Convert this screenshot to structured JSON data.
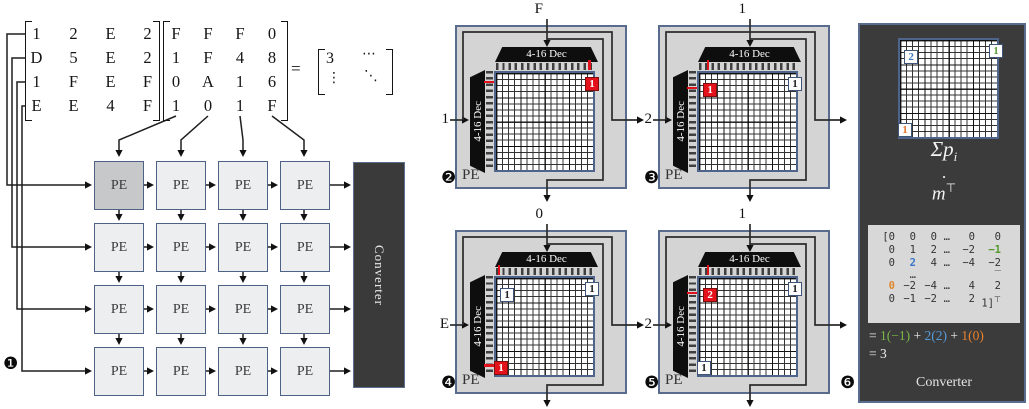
{
  "equation": {
    "matrix_a": {
      "rows": [
        [
          "1",
          "2",
          "E",
          "2"
        ],
        [
          "D",
          "5",
          "E",
          "2"
        ],
        [
          "1",
          "F",
          "E",
          "F"
        ],
        [
          "E",
          "E",
          "4",
          "F"
        ]
      ]
    },
    "matrix_b": {
      "rows": [
        [
          "F",
          "F",
          "F",
          "0"
        ],
        [
          "1",
          "F",
          "4",
          "8"
        ],
        [
          "0",
          "A",
          "1",
          "6"
        ],
        [
          "1",
          "0",
          "1",
          "F"
        ]
      ]
    },
    "equals": "=",
    "result": {
      "top_left": "3",
      "top_right": "⋯",
      "bottom_left": "⋮",
      "bottom_right": "⋱"
    }
  },
  "pe_array": {
    "badge": "❶",
    "pe_label": "PE",
    "converter_label": "Converter"
  },
  "pe_panels": [
    {
      "badge": "❷",
      "top_input": "F",
      "left_input": "1",
      "top_decoder": "4-16 Dec",
      "left_decoder": "4-16 Dec",
      "pe_label": "PE",
      "marks": [
        {
          "row": 1,
          "col": 15,
          "value": "1",
          "style": "red"
        }
      ],
      "tick_col": 15,
      "tick_row": 1
    },
    {
      "badge": "❸",
      "top_input": "1",
      "left_input": "2",
      "top_decoder": "4-16 Dec",
      "left_decoder": "4-16 Dec",
      "pe_label": "PE",
      "marks": [
        {
          "row": 2,
          "col": 1,
          "value": "1",
          "style": "red"
        },
        {
          "row": 1,
          "col": 15,
          "value": "1",
          "style": "white"
        }
      ],
      "tick_col": 1,
      "tick_row": 2
    },
    {
      "badge": "❹",
      "top_input": "0",
      "left_input": "E",
      "top_decoder": "4-16 Dec",
      "left_decoder": "4-16 Dec",
      "pe_label": "PE",
      "marks": [
        {
          "row": 14,
          "col": 0,
          "value": "1",
          "style": "red"
        },
        {
          "row": 2,
          "col": 1,
          "value": "1",
          "style": "white"
        },
        {
          "row": 1,
          "col": 15,
          "value": "1",
          "style": "white"
        }
      ],
      "tick_col": 0,
      "tick_row": 14
    },
    {
      "badge": "❺",
      "top_input": "1",
      "left_input": "2",
      "top_decoder": "4-16 Dec",
      "left_decoder": "4-16 Dec",
      "pe_label": "PE",
      "marks": [
        {
          "row": 2,
          "col": 1,
          "value": "2",
          "style": "red"
        },
        {
          "row": 1,
          "col": 15,
          "value": "1",
          "style": "white"
        },
        {
          "row": 14,
          "col": 0,
          "value": "1",
          "style": "white"
        }
      ],
      "tick_col": 1,
      "tick_row": 2
    }
  ],
  "converter_panel": {
    "badge": "❻",
    "marks": [
      {
        "row": 1,
        "col": 15,
        "value": "1",
        "style": "green"
      },
      {
        "row": 2,
        "col": 1,
        "value": "2",
        "style": "blue"
      },
      {
        "row": 14,
        "col": 0,
        "value": "1",
        "style": "orange"
      }
    ],
    "formula": {
      "sum_base": "Σp",
      "sum_sub": "i",
      "dot": "·",
      "m_base": "m",
      "m_sup": "⊤"
    },
    "m_matrix": {
      "rows": [
        [
          {
            "t": "[0"
          },
          {
            "t": "0"
          },
          {
            "t": "0"
          },
          {
            "t": "…"
          },
          {
            "t": "0"
          },
          {
            "t": "0"
          }
        ],
        [
          {
            "t": "0"
          },
          {
            "t": "1"
          },
          {
            "t": "2"
          },
          {
            "t": "…"
          },
          {
            "t": "−2"
          },
          {
            "t": "−1",
            "c": "green"
          }
        ],
        [
          {
            "t": "0"
          },
          {
            "t": "2",
            "c": "blue"
          },
          {
            "t": "4"
          },
          {
            "t": "…"
          },
          {
            "t": "−4"
          },
          {
            "t": "−2"
          }
        ],
        [
          {
            "t": ""
          },
          {
            "t": "…"
          },
          {
            "t": ""
          },
          {
            "t": ""
          },
          {
            "t": ""
          },
          {
            "t": "‾"
          }
        ],
        [
          {
            "t": "0",
            "c": "orange"
          },
          {
            "t": "−2"
          },
          {
            "t": "−4"
          },
          {
            "t": "…"
          },
          {
            "t": "4"
          },
          {
            "t": "2"
          }
        ],
        [
          {
            "t": "0"
          },
          {
            "t": "−1"
          },
          {
            "t": "−2"
          },
          {
            "t": "…"
          },
          {
            "t": "2"
          },
          {
            "t": "1]",
            "sup": "⊤"
          }
        ]
      ]
    },
    "equation_line1": [
      {
        "t": "= ",
        "c": "w"
      },
      {
        "t": "1(−1)",
        "c": "g"
      },
      {
        "t": " + ",
        "c": "w"
      },
      {
        "t": "2(2)",
        "c": "b"
      },
      {
        "t": " + ",
        "c": "w"
      },
      {
        "t": "1(0)",
        "c": "o"
      }
    ],
    "equation_line2": "= 3",
    "label": "Converter"
  }
}
